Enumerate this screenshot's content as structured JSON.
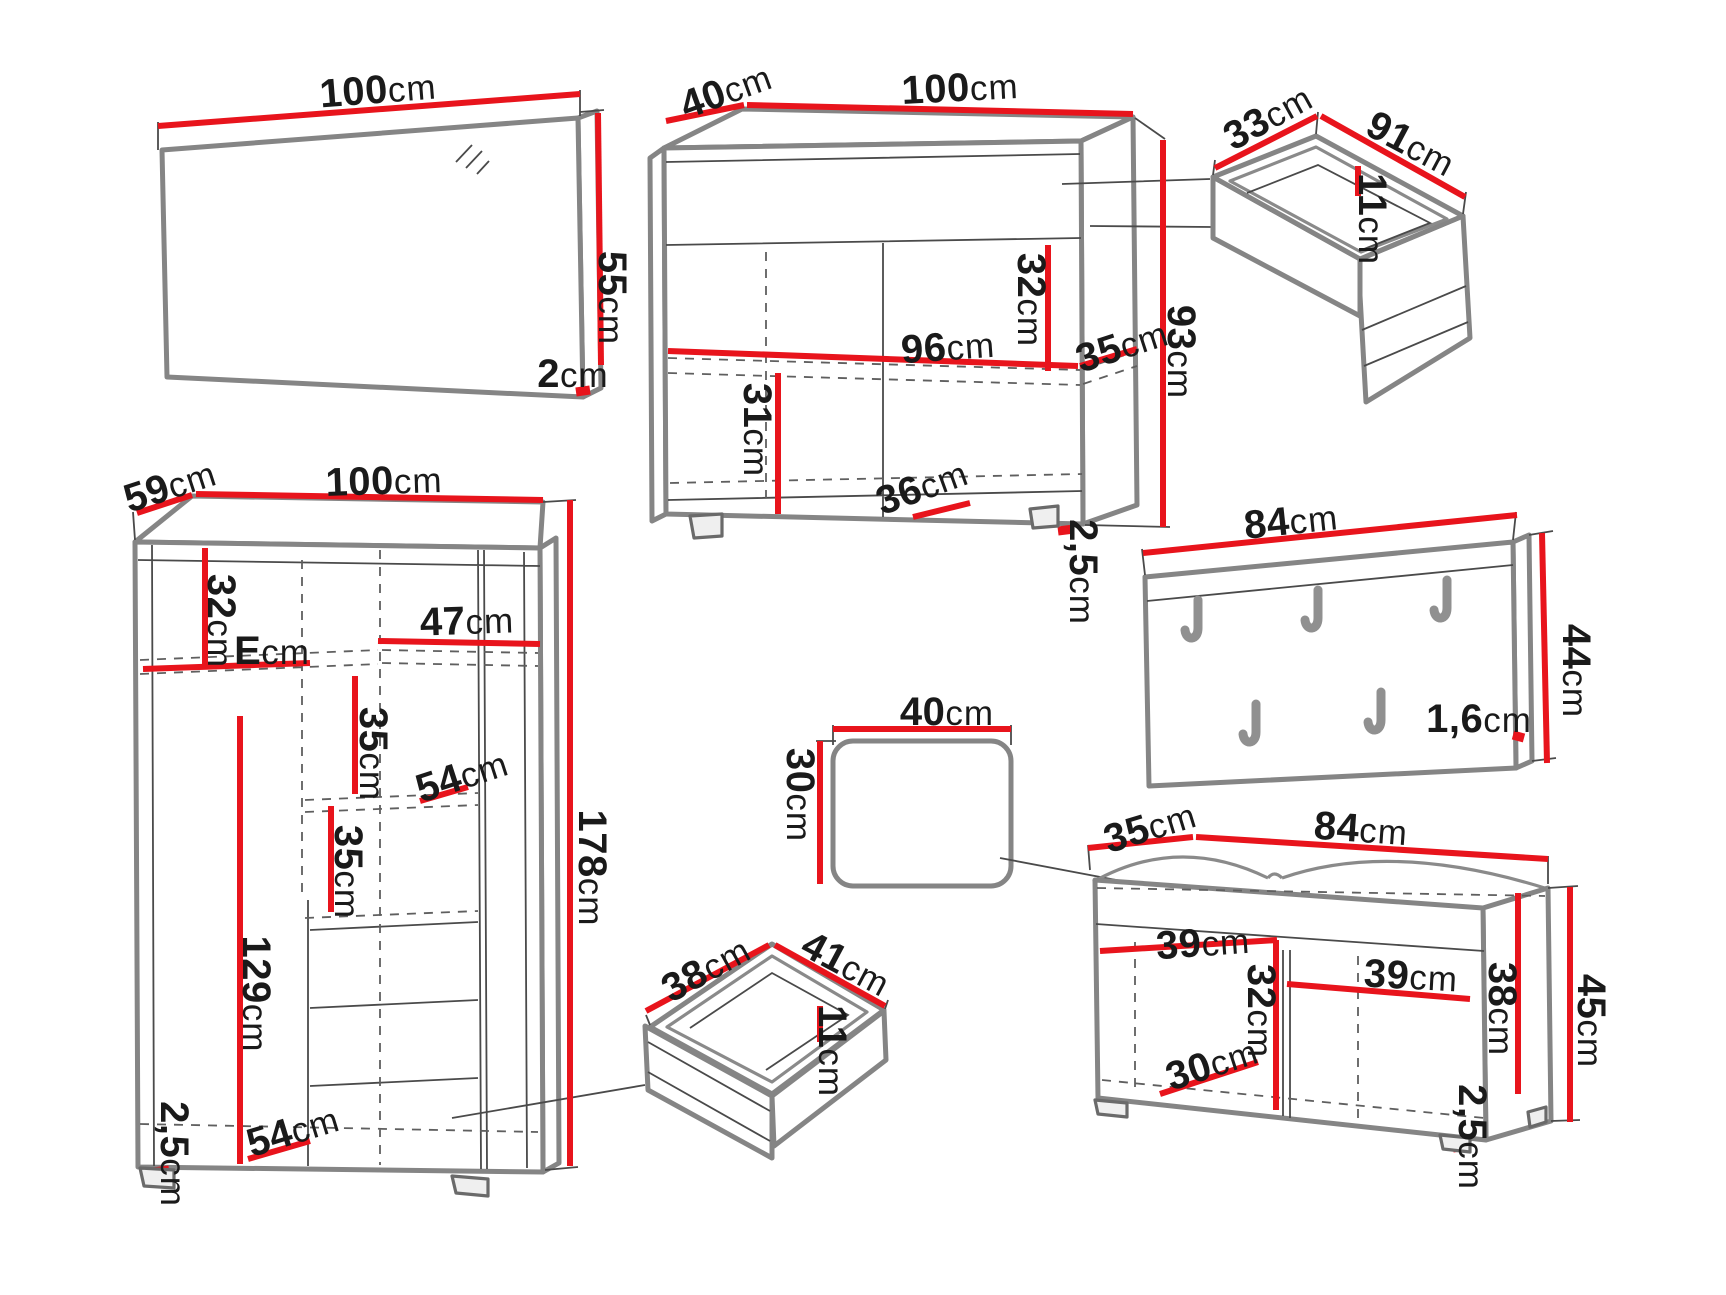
{
  "colors": {
    "dimension_red": "#e8141c",
    "outline_gray": "#858585",
    "label_black": "#1a1a1a",
    "background": "#ffffff"
  },
  "furniture": {
    "mirror": {
      "name": "mirror",
      "dims": {
        "width": {
          "value": "100",
          "unit": "cm"
        },
        "height": {
          "value": "55",
          "unit": "cm"
        },
        "thickness": {
          "value": "2",
          "unit": "cm"
        }
      }
    },
    "sideboard": {
      "name": "sideboard",
      "dims": {
        "depth": {
          "value": "40",
          "unit": "cm"
        },
        "width": {
          "value": "100",
          "unit": "cm"
        },
        "top_inner_height": {
          "value": "32",
          "unit": "cm"
        },
        "inner_width": {
          "value": "96",
          "unit": "cm"
        },
        "inner_depth": {
          "value": "35",
          "unit": "cm"
        },
        "height": {
          "value": "93",
          "unit": "cm"
        },
        "bottom_inner_height": {
          "value": "31",
          "unit": "cm"
        },
        "compartment_width": {
          "value": "36",
          "unit": "cm"
        },
        "plinth_height": {
          "value": "2,5",
          "unit": "cm"
        }
      }
    },
    "top_drawer": {
      "name": "drawer",
      "dims": {
        "inner_depth": {
          "value": "33",
          "unit": "cm"
        },
        "inner_width": {
          "value": "91",
          "unit": "cm"
        },
        "inner_height": {
          "value": "11",
          "unit": "cm"
        }
      }
    },
    "wardrobe": {
      "name": "wardrobe",
      "dims": {
        "depth": {
          "value": "59",
          "unit": "cm"
        },
        "width": {
          "value": "100",
          "unit": "cm"
        },
        "top_inner_height": {
          "value": "32",
          "unit": "cm"
        },
        "right_shelf_width": {
          "value": "47",
          "unit": "cm"
        },
        "left_shelf_width": {
          "value": "E",
          "unit": "cm"
        },
        "shelf_gap_upper": {
          "value": "35",
          "unit": "cm"
        },
        "shelf_depth": {
          "value": "54",
          "unit": "cm"
        },
        "shelf_gap_lower": {
          "value": "35",
          "unit": "cm"
        },
        "hanging_height": {
          "value": "129",
          "unit": "cm"
        },
        "height": {
          "value": "178",
          "unit": "cm"
        },
        "bottom_shelf_depth": {
          "value": "54",
          "unit": "cm"
        },
        "plinth_height": {
          "value": "2,5",
          "unit": "cm"
        }
      }
    },
    "coat_panel": {
      "name": "coat-panel",
      "dims": {
        "width": {
          "value": "84",
          "unit": "cm"
        },
        "height": {
          "value": "44",
          "unit": "cm"
        },
        "thickness": {
          "value": "1,6",
          "unit": "cm"
        }
      }
    },
    "pouf": {
      "name": "pouf",
      "dims": {
        "width": {
          "value": "40",
          "unit": "cm"
        },
        "height": {
          "value": "30",
          "unit": "cm"
        }
      }
    },
    "bench": {
      "name": "shoe-bench",
      "dims": {
        "depth": {
          "value": "35",
          "unit": "cm"
        },
        "width": {
          "value": "84",
          "unit": "cm"
        },
        "left_compartment_width": {
          "value": "39",
          "unit": "cm"
        },
        "right_compartment_width": {
          "value": "39",
          "unit": "cm"
        },
        "inner_height": {
          "value": "32",
          "unit": "cm"
        },
        "compartment_depth": {
          "value": "30",
          "unit": "cm"
        },
        "side_inner_height": {
          "value": "38",
          "unit": "cm"
        },
        "height": {
          "value": "45",
          "unit": "cm"
        },
        "plinth_height": {
          "value": "2,5",
          "unit": "cm"
        }
      }
    },
    "bottom_drawer": {
      "name": "drawer",
      "dims": {
        "inner_depth": {
          "value": "38",
          "unit": "cm"
        },
        "inner_width": {
          "value": "41",
          "unit": "cm"
        },
        "inner_height": {
          "value": "11",
          "unit": "cm"
        }
      }
    }
  }
}
